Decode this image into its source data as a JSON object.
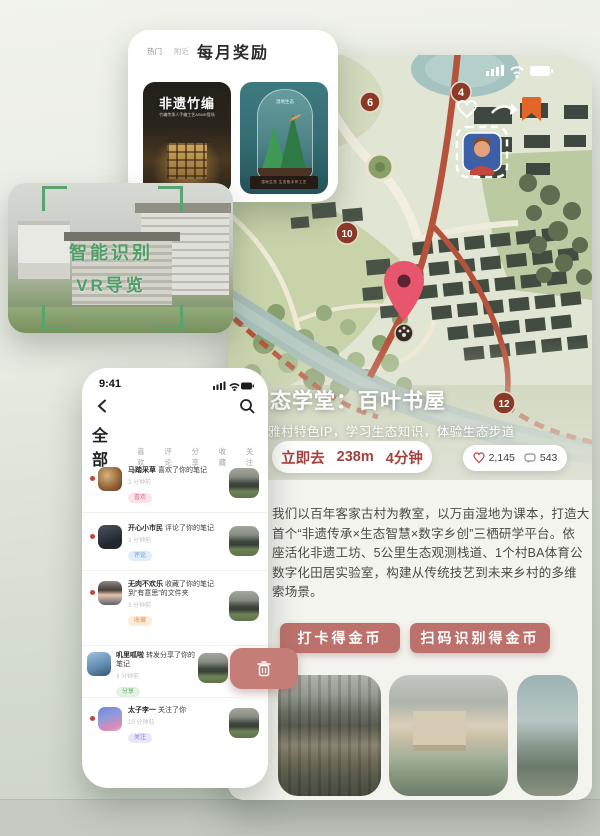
{
  "rewards": {
    "tab_hot": "热门",
    "tab_nearby": "附近",
    "title": "每月奖励",
    "item1_title": "非遗竹编",
    "item1_caption": "竹编传承人手编工艺ASMR登场",
    "item2_label": "湿地生态",
    "item2_caption": "湿地生态 生态瓶手作工艺"
  },
  "vr": {
    "line1": "智能识别",
    "line2": "VR导览"
  },
  "notify": {
    "time": "9:41",
    "tabs": {
      "all": "全部",
      "like": "喜欢",
      "comment": "评论",
      "share": "分享",
      "favorite": "收藏",
      "follow": "关注"
    },
    "items": [
      {
        "name": "马踏采草",
        "action": "喜欢了你的笔记",
        "time": "2 分钟前",
        "badge": "喜欢"
      },
      {
        "name": "开心小市民",
        "action": "评论了你的笔记",
        "time": "3 分钟前",
        "badge": "评论"
      },
      {
        "name": "无肉不欢乐",
        "action": "收藏了你的笔记到“有意思”的文件夹",
        "time": "3 分钟前",
        "badge": "收藏"
      },
      {
        "name": "叽里呱啦",
        "action": "转发分享了你的笔记",
        "time": "3 分钟前",
        "badge": "分享"
      },
      {
        "name": "太子李一",
        "action": "关注了你",
        "time": "10 分钟前",
        "badge": "关注"
      }
    ]
  },
  "map": {
    "markers": {
      "m4": "4",
      "m6": "6",
      "m10": "10",
      "m12": "12"
    },
    "poi_title": "态学堂：百叶书屋",
    "poi_subtitle": "雅村特色IP，学习生态知识，体验生态步道",
    "go": "立即去",
    "distance": "238m",
    "duration": "4分钟",
    "likes": "2,145",
    "comments": "543",
    "desc_lines": [
      "我们以百年客家古村为教室，以万亩湿地为课本，打造大",
      "首个“非遗传承×生态智慧×数字乡创”三栖研学平台。依",
      "座活化非遗工坊、5公里生态观测栈道、1个村BA体育公",
      "数字化田居实验室，构建从传统技艺到未来乡村的多维",
      "索场景。"
    ],
    "btn_checkin": "打卡得金币",
    "btn_scan": "扫码识别得金币"
  }
}
